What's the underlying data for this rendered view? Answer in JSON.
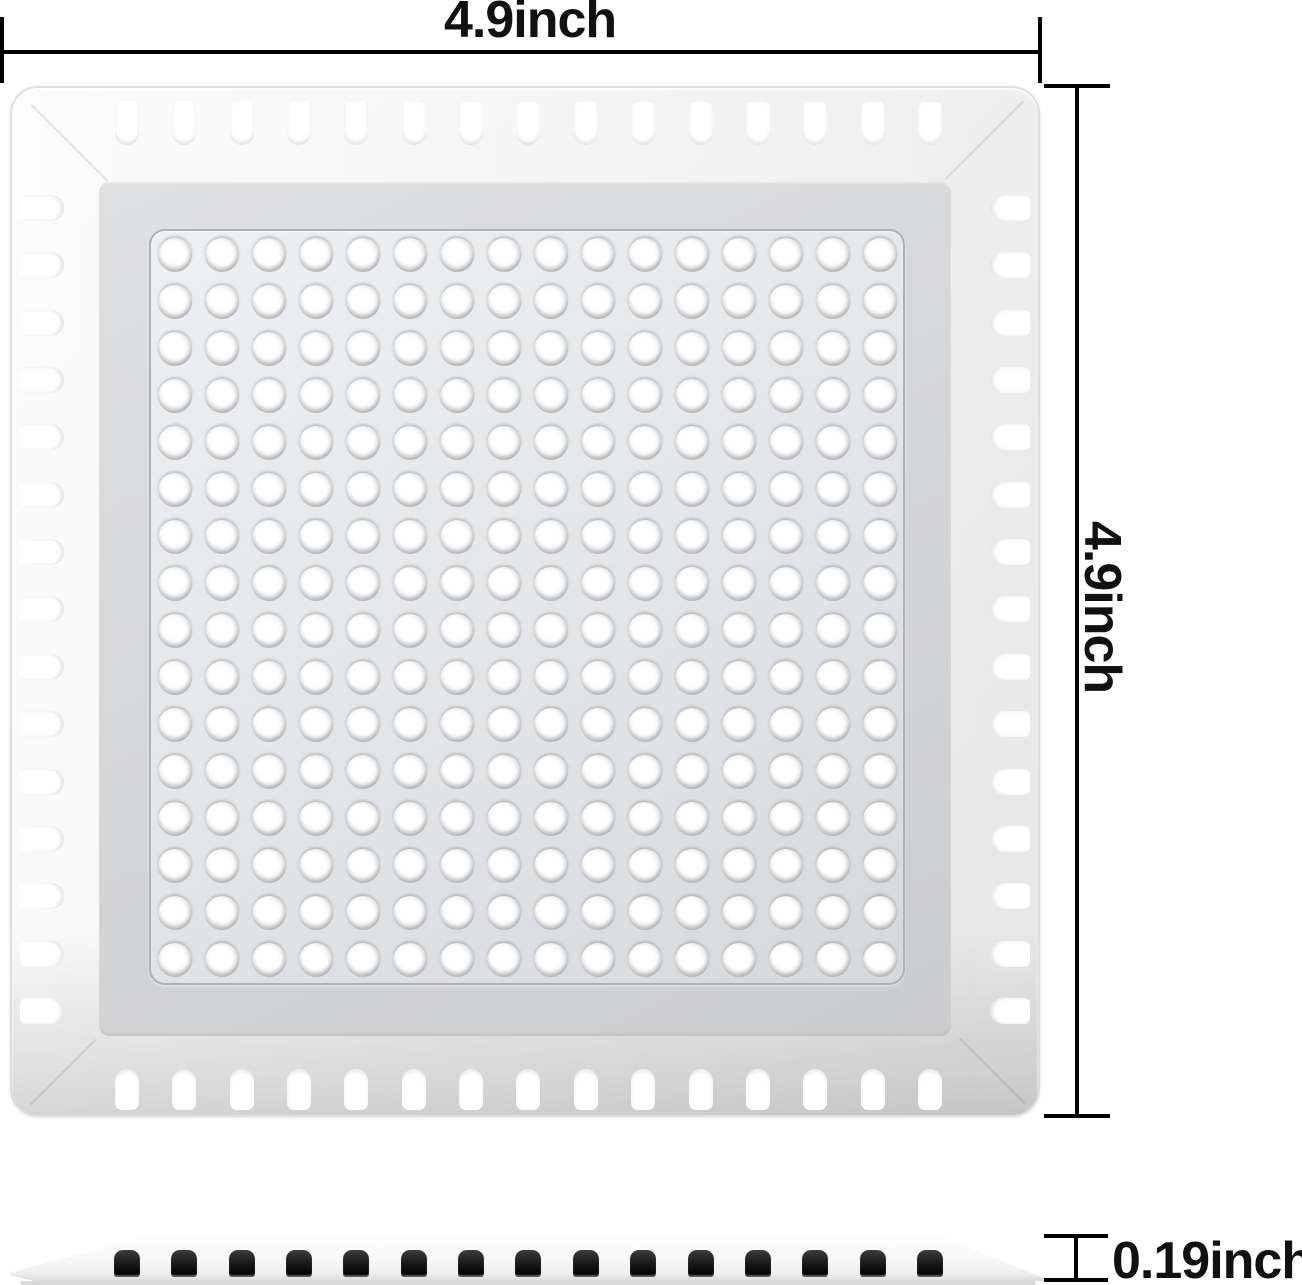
{
  "diagram_labels": {
    "width": "4.9inch",
    "height": "4.9inch",
    "thickness": "0.19inch"
  },
  "plate": {
    "hole_rows": 16,
    "hole_cols": 16,
    "edge_slots_per_side": 15,
    "side_view_slot_count": 15
  },
  "colors": {
    "background": "#ffffff",
    "dimension_lines": "#000000",
    "label_text": "#111111",
    "frame_light": "#f7f7f7",
    "floor_band": "#d4d5d7",
    "panel_face": "#e4e6e8",
    "hole_fill": "#ffffff",
    "side_slot_dark": "#161616"
  }
}
